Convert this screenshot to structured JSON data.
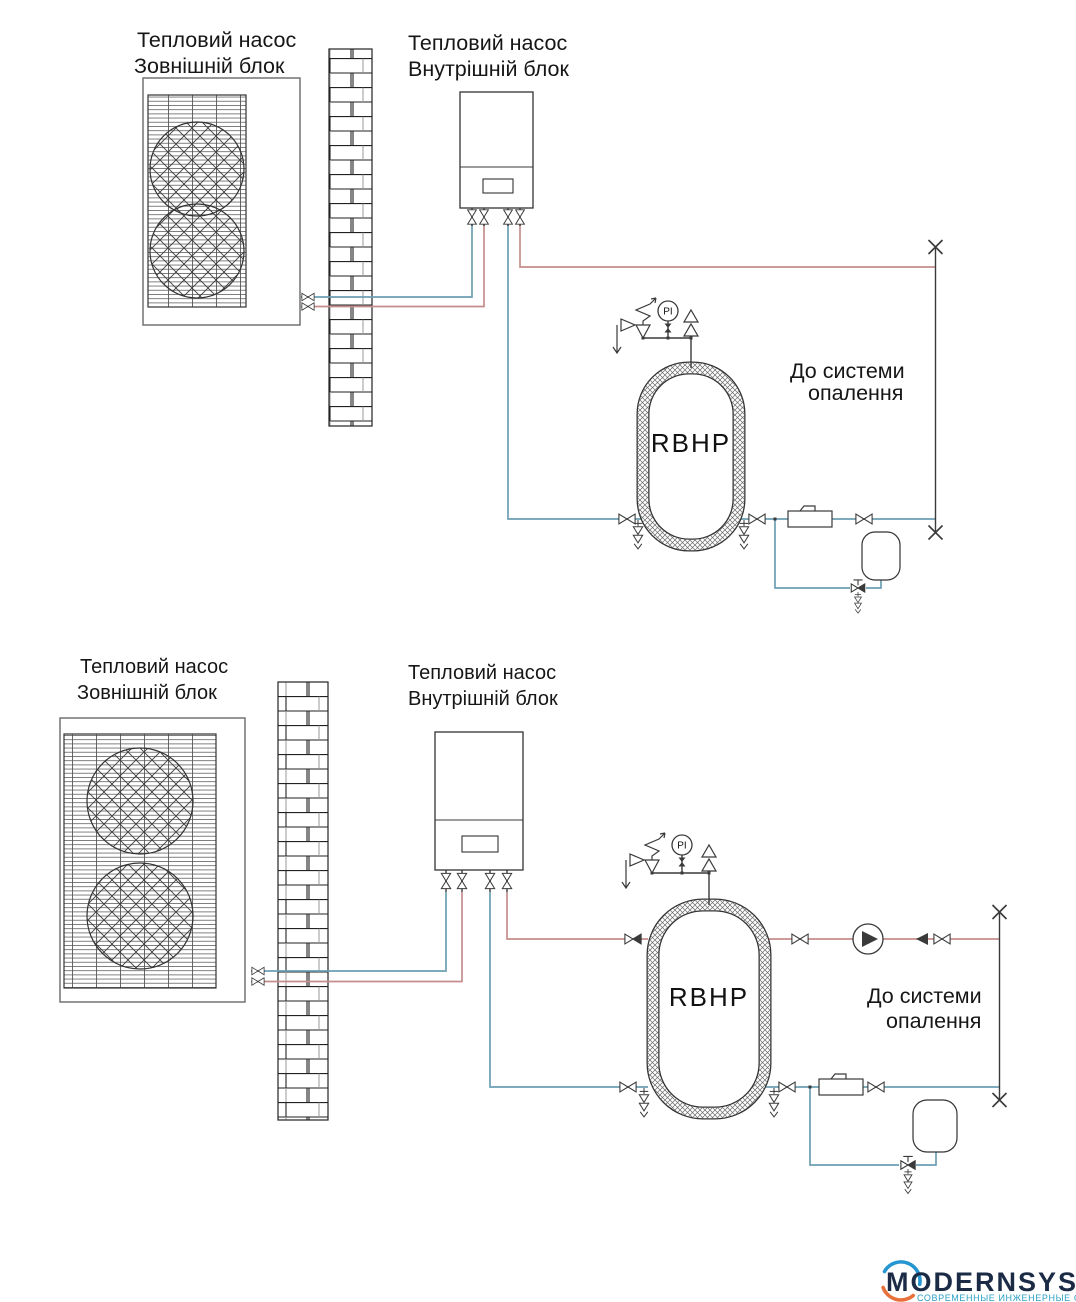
{
  "colors": {
    "hot": "#c48d8c",
    "cold": "#6b9fb3",
    "line": "#3a3a3a",
    "navy": "#1b2b45",
    "blue": "#2596d1",
    "orange": "#e8713b",
    "teal": "#2aa0c4"
  },
  "d1": {
    "outdoor_label": [
      "Тепловий насос",
      "Зовнішній блок"
    ],
    "indoor_label": [
      "Тепловий насос",
      "Внутрішній блок"
    ],
    "tank_label": "RBHP",
    "gauge_label": "PI",
    "system_label": [
      "До системи",
      "опалення"
    ]
  },
  "d2": {
    "outdoor_label": [
      "Тепловий насос",
      "Зовнішній блок"
    ],
    "indoor_label": [
      "Тепловий насос",
      "Внутрішній блок"
    ],
    "tank_label": "RBHP",
    "gauge_label": "PI",
    "system_label": [
      "До системи",
      "опалення"
    ]
  },
  "logo": {
    "brand": "MODERNSYS",
    "tagline": "СОВРЕМЕННЫЕ ИНЖЕНЕРНЫЕ СИСТЕМЫ"
  }
}
